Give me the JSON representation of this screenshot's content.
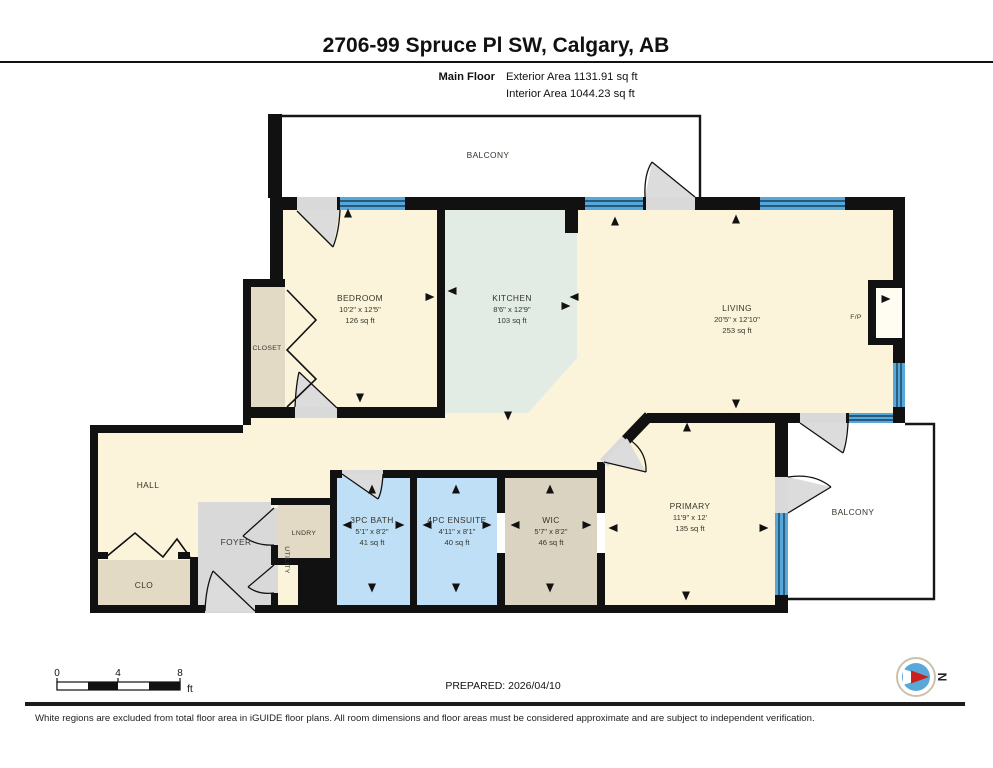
{
  "header": {
    "title": "2706-99 Spruce Pl SW, Calgary, AB",
    "floor_label": "Main Floor",
    "exterior_area": "Exterior Area 1131.91 sq ft",
    "interior_area": "Interior Area 1044.23 sq ft"
  },
  "rooms": {
    "balcony_top": {
      "name": "BALCONY"
    },
    "bedroom": {
      "name": "BEDROOM",
      "dims": "10'2\" x 12'5\"",
      "area": "126 sq ft"
    },
    "closet": {
      "name": "CLOSET"
    },
    "kitchen": {
      "name": "KITCHEN",
      "dims": "8'6\" x 12'9\"",
      "area": "103 sq ft"
    },
    "living": {
      "name": "LIVING",
      "dims": "20'5\" x 12'10\"",
      "area": "253 sq ft"
    },
    "fireplace": {
      "name": "F/P"
    },
    "hall": {
      "name": "HALL"
    },
    "foyer": {
      "name": "FOYER"
    },
    "laundry": {
      "name": "LNDRY"
    },
    "utility": {
      "name": "UTILITY"
    },
    "clo": {
      "name": "CLO"
    },
    "bath": {
      "name": "3PC BATH",
      "dims": "5'1\" x 8'2\"",
      "area": "41 sq ft"
    },
    "ensuite": {
      "name": "4PC ENSUITE",
      "dims": "4'11\" x 8'1\"",
      "area": "40 sq ft"
    },
    "wic": {
      "name": "WIC",
      "dims": "5'7\" x 8'2\"",
      "area": "46 sq ft"
    },
    "primary": {
      "name": "PRIMARY",
      "dims": "11'9\" x 12'",
      "area": "135 sq ft"
    },
    "balcony_right": {
      "name": "BALCONY"
    }
  },
  "scale_bar": {
    "tick0": "0",
    "tick4": "4",
    "tick8": "8",
    "unit": "ft"
  },
  "footer": {
    "prepared": "PREPARED: 2026/04/10",
    "disclaimer": "White regions are excluded from total floor area in iGUIDE floor plans. All room dimensions and floor areas must be considered approximate and are subject to independent verification."
  },
  "compass": {
    "label": "N"
  },
  "colors": {
    "floor_cream": "#FBF4DA",
    "closet_tan": "#E2DAC5",
    "wic_tan": "#DBD3C2",
    "foyer_gray": "#D9D9D9",
    "bath_blue": "#BFDFF6",
    "kitchen_green": "#E2ECE5",
    "window_blue": "#57A7DB",
    "wall_black": "#111111",
    "compass_blue": "#58A8D8",
    "compass_red": "#CC1F1F"
  },
  "arrows": [
    {
      "x": 348,
      "y": 213,
      "d": "up"
    },
    {
      "x": 360,
      "y": 398,
      "d": "down"
    },
    {
      "x": 430,
      "y": 297,
      "d": "right"
    },
    {
      "x": 452,
      "y": 291,
      "d": "left"
    },
    {
      "x": 566,
      "y": 306,
      "d": "right"
    },
    {
      "x": 574,
      "y": 297,
      "d": "left"
    },
    {
      "x": 508,
      "y": 416,
      "d": "down"
    },
    {
      "x": 615,
      "y": 221,
      "d": "up"
    },
    {
      "x": 736,
      "y": 219,
      "d": "up"
    },
    {
      "x": 736,
      "y": 404,
      "d": "down"
    },
    {
      "x": 886,
      "y": 299,
      "d": "right"
    },
    {
      "x": 687,
      "y": 427,
      "d": "up"
    },
    {
      "x": 686,
      "y": 596,
      "d": "down"
    },
    {
      "x": 613,
      "y": 528,
      "d": "left"
    },
    {
      "x": 764,
      "y": 528,
      "d": "right"
    },
    {
      "x": 347,
      "y": 525,
      "d": "left"
    },
    {
      "x": 400,
      "y": 525,
      "d": "right"
    },
    {
      "x": 372,
      "y": 489,
      "d": "up"
    },
    {
      "x": 372,
      "y": 588,
      "d": "down"
    },
    {
      "x": 427,
      "y": 525,
      "d": "left"
    },
    {
      "x": 487,
      "y": 525,
      "d": "right"
    },
    {
      "x": 456,
      "y": 489,
      "d": "up"
    },
    {
      "x": 456,
      "y": 588,
      "d": "down"
    },
    {
      "x": 515,
      "y": 525,
      "d": "left"
    },
    {
      "x": 587,
      "y": 525,
      "d": "right"
    },
    {
      "x": 550,
      "y": 489,
      "d": "up"
    },
    {
      "x": 550,
      "y": 588,
      "d": "down"
    }
  ]
}
